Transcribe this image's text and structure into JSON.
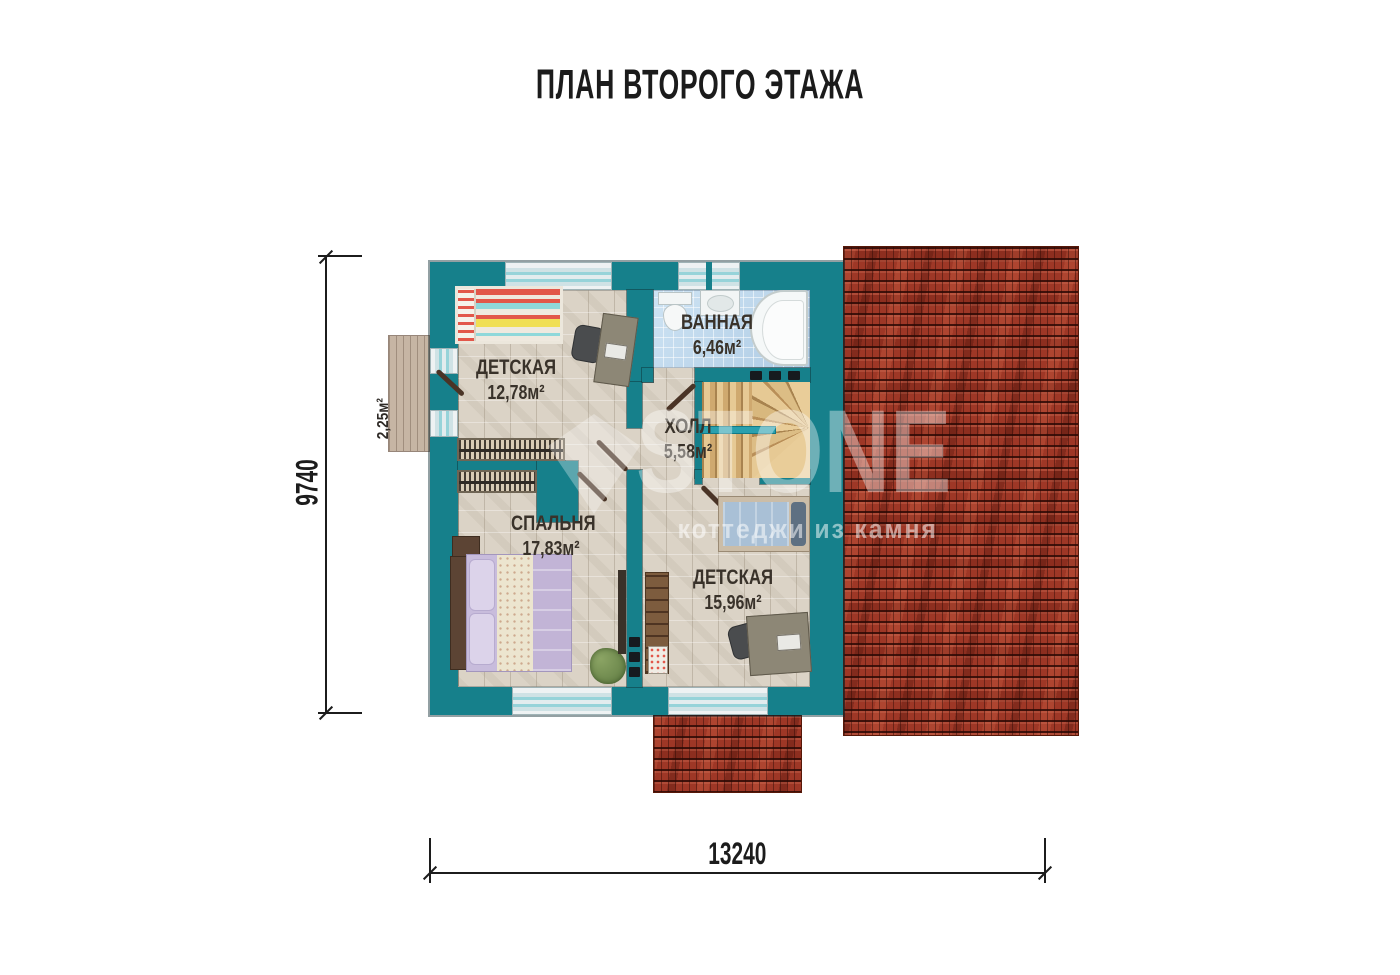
{
  "title": "ПЛАН ВТОРОГО ЭТАЖА",
  "rooms": {
    "nursery1": {
      "name": "ДЕТСКАЯ",
      "area": "12,78м²"
    },
    "bathroom": {
      "name": "ВАННАЯ",
      "area": "6,46м²"
    },
    "hall": {
      "name": "ХОЛЛ",
      "area": "5,58м²"
    },
    "bedroom": {
      "name": "СПАЛЬНЯ",
      "area": "17,83м²"
    },
    "nursery2": {
      "name": "ДЕТСКАЯ",
      "area": "15,96м²"
    },
    "balcony": {
      "area": "2,25м²"
    }
  },
  "dimensions": {
    "horizontal": "13240",
    "vertical": "9740"
  },
  "watermark": {
    "logo": "STONE",
    "tagline": "коттеджи из камня"
  },
  "colors": {
    "wall_teal": "#16808b",
    "roof_red": "#9e3726",
    "floor_beige": "#dbd3c6",
    "bath_tile_blue": "#bcd8ee",
    "stair_wood": "#dfc08a",
    "dimension_black": "#1c1c1c"
  }
}
